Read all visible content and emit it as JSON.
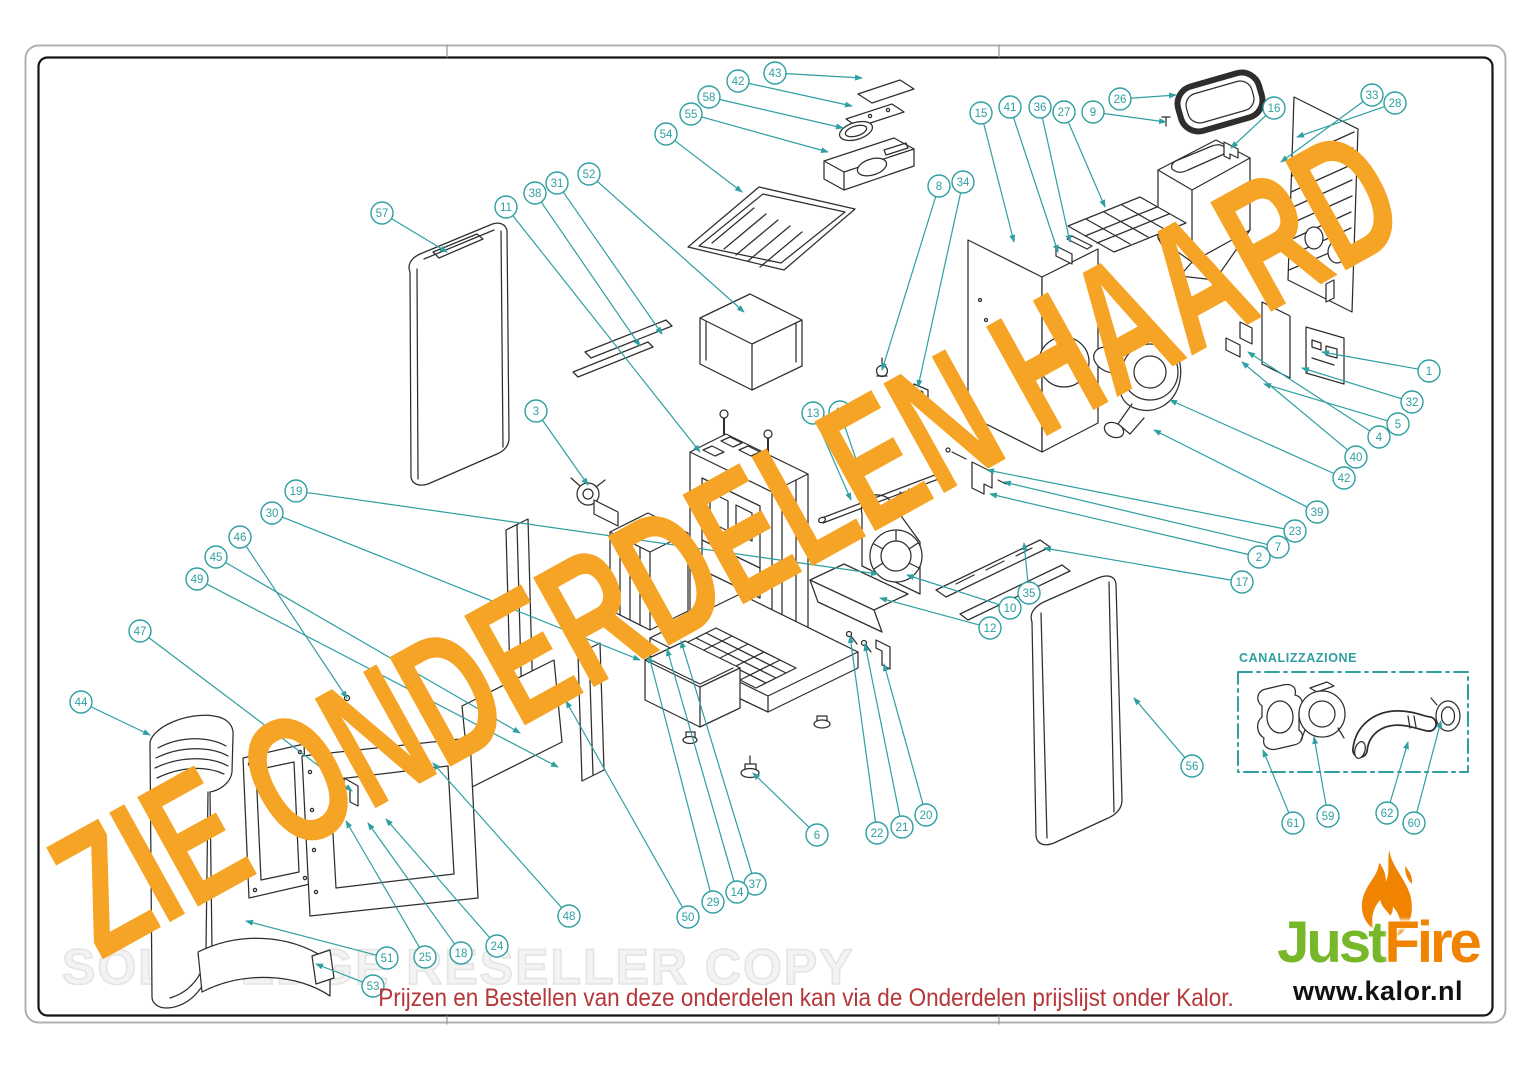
{
  "page": {
    "diagonal_watermark": "ZIE ONDERDELEN HAARD",
    "background_watermark": "SOLID EDGE RESELLER COPY",
    "footer_note": "Prijzen en Bestellen van deze onderdelen kan via de Onderdelen prijslijst onder Kalor."
  },
  "inset": {
    "label": "CANALIZZAZIONE"
  },
  "logo": {
    "brand_part1": "Just",
    "brand_part2": "Fire",
    "website": "www.kalor.nl",
    "flame_icon": "flame-icon"
  },
  "colors": {
    "callout": "#2f9fa1",
    "line_art": "#2e2e2e",
    "watermark_orange": "#f5a425",
    "footer_red": "#b5373a",
    "logo_green": "#76b82a",
    "logo_orange": "#f08300",
    "reseller_gray": "#e4e4e4"
  },
  "callouts": [
    [
      "43",
      775,
      73,
      862,
      78
    ],
    [
      "42",
      738,
      81,
      852,
      106
    ],
    [
      "58",
      709,
      97,
      843,
      128
    ],
    [
      "55",
      691,
      114,
      828,
      152
    ],
    [
      "54",
      666,
      134,
      742,
      192
    ],
    [
      "26",
      1120,
      99,
      1176,
      95
    ],
    [
      "9",
      1093,
      112,
      1166,
      122
    ],
    [
      "27",
      1064,
      112,
      1105,
      207
    ],
    [
      "36",
      1040,
      107,
      1070,
      242
    ],
    [
      "41",
      1010,
      107,
      1058,
      252
    ],
    [
      "15",
      981,
      113,
      1014,
      242
    ],
    [
      "16",
      1274,
      108,
      1231,
      148
    ],
    [
      "33",
      1372,
      95,
      1281,
      162
    ],
    [
      "28",
      1395,
      103,
      1297,
      137
    ],
    [
      "8",
      939,
      186,
      882,
      370
    ],
    [
      "34",
      963,
      182,
      918,
      387
    ],
    [
      "57",
      382,
      213,
      447,
      252
    ],
    [
      "11",
      506,
      207,
      700,
      452
    ],
    [
      "38",
      535,
      193,
      640,
      346
    ],
    [
      "31",
      557,
      183,
      662,
      334
    ],
    [
      "52",
      589,
      174,
      744,
      312
    ],
    [
      "3",
      536,
      411,
      588,
      485
    ],
    [
      "13",
      813,
      413,
      851,
      500
    ],
    [
      "43",
      840,
      412,
      867,
      492
    ],
    [
      "19",
      296,
      491,
      878,
      574
    ],
    [
      "30",
      272,
      513,
      640,
      660
    ],
    [
      "46",
      240,
      537,
      347,
      698
    ],
    [
      "45",
      216,
      557,
      520,
      733
    ],
    [
      "49",
      197,
      579,
      558,
      767
    ],
    [
      "47",
      140,
      631,
      352,
      791
    ],
    [
      "44",
      81,
      702,
      150,
      735
    ],
    [
      "1",
      1429,
      371,
      1322,
      352
    ],
    [
      "32",
      1412,
      402,
      1302,
      368
    ],
    [
      "5",
      1398,
      424,
      1264,
      384
    ],
    [
      "4",
      1379,
      437,
      1248,
      352
    ],
    [
      "40",
      1356,
      457,
      1242,
      362
    ],
    [
      "42",
      1344,
      478,
      1170,
      400
    ],
    [
      "39",
      1317,
      512,
      1154,
      430
    ],
    [
      "23",
      1295,
      531,
      987,
      470
    ],
    [
      "7",
      1278,
      547,
      1004,
      482
    ],
    [
      "2",
      1259,
      557,
      990,
      494
    ],
    [
      "17",
      1242,
      582,
      1044,
      548
    ],
    [
      "35",
      1029,
      593,
      1024,
      543
    ],
    [
      "10",
      1010,
      608,
      907,
      575
    ],
    [
      "12",
      990,
      628,
      880,
      598
    ],
    [
      "56",
      1192,
      766,
      1134,
      698
    ],
    [
      "6",
      817,
      835,
      753,
      773
    ],
    [
      "22",
      877,
      833,
      850,
      636
    ],
    [
      "21",
      902,
      827,
      865,
      644
    ],
    [
      "20",
      926,
      815,
      884,
      664
    ],
    [
      "37",
      755,
      884,
      681,
      641
    ],
    [
      "14",
      737,
      892,
      667,
      649
    ],
    [
      "29",
      713,
      902,
      649,
      656
    ],
    [
      "50",
      688,
      917,
      566,
      701
    ],
    [
      "48",
      569,
      916,
      433,
      763
    ],
    [
      "24",
      497,
      946,
      386,
      819
    ],
    [
      "18",
      461,
      953,
      368,
      823
    ],
    [
      "25",
      425,
      957,
      346,
      821
    ],
    [
      "51",
      387,
      958,
      246,
      921
    ],
    [
      "53",
      373,
      986,
      316,
      964
    ],
    [
      "61",
      1293,
      823,
      1263,
      750
    ],
    [
      "59",
      1328,
      816,
      1314,
      737
    ],
    [
      "62",
      1387,
      813,
      1408,
      742
    ],
    [
      "60",
      1414,
      823,
      1441,
      721
    ]
  ]
}
